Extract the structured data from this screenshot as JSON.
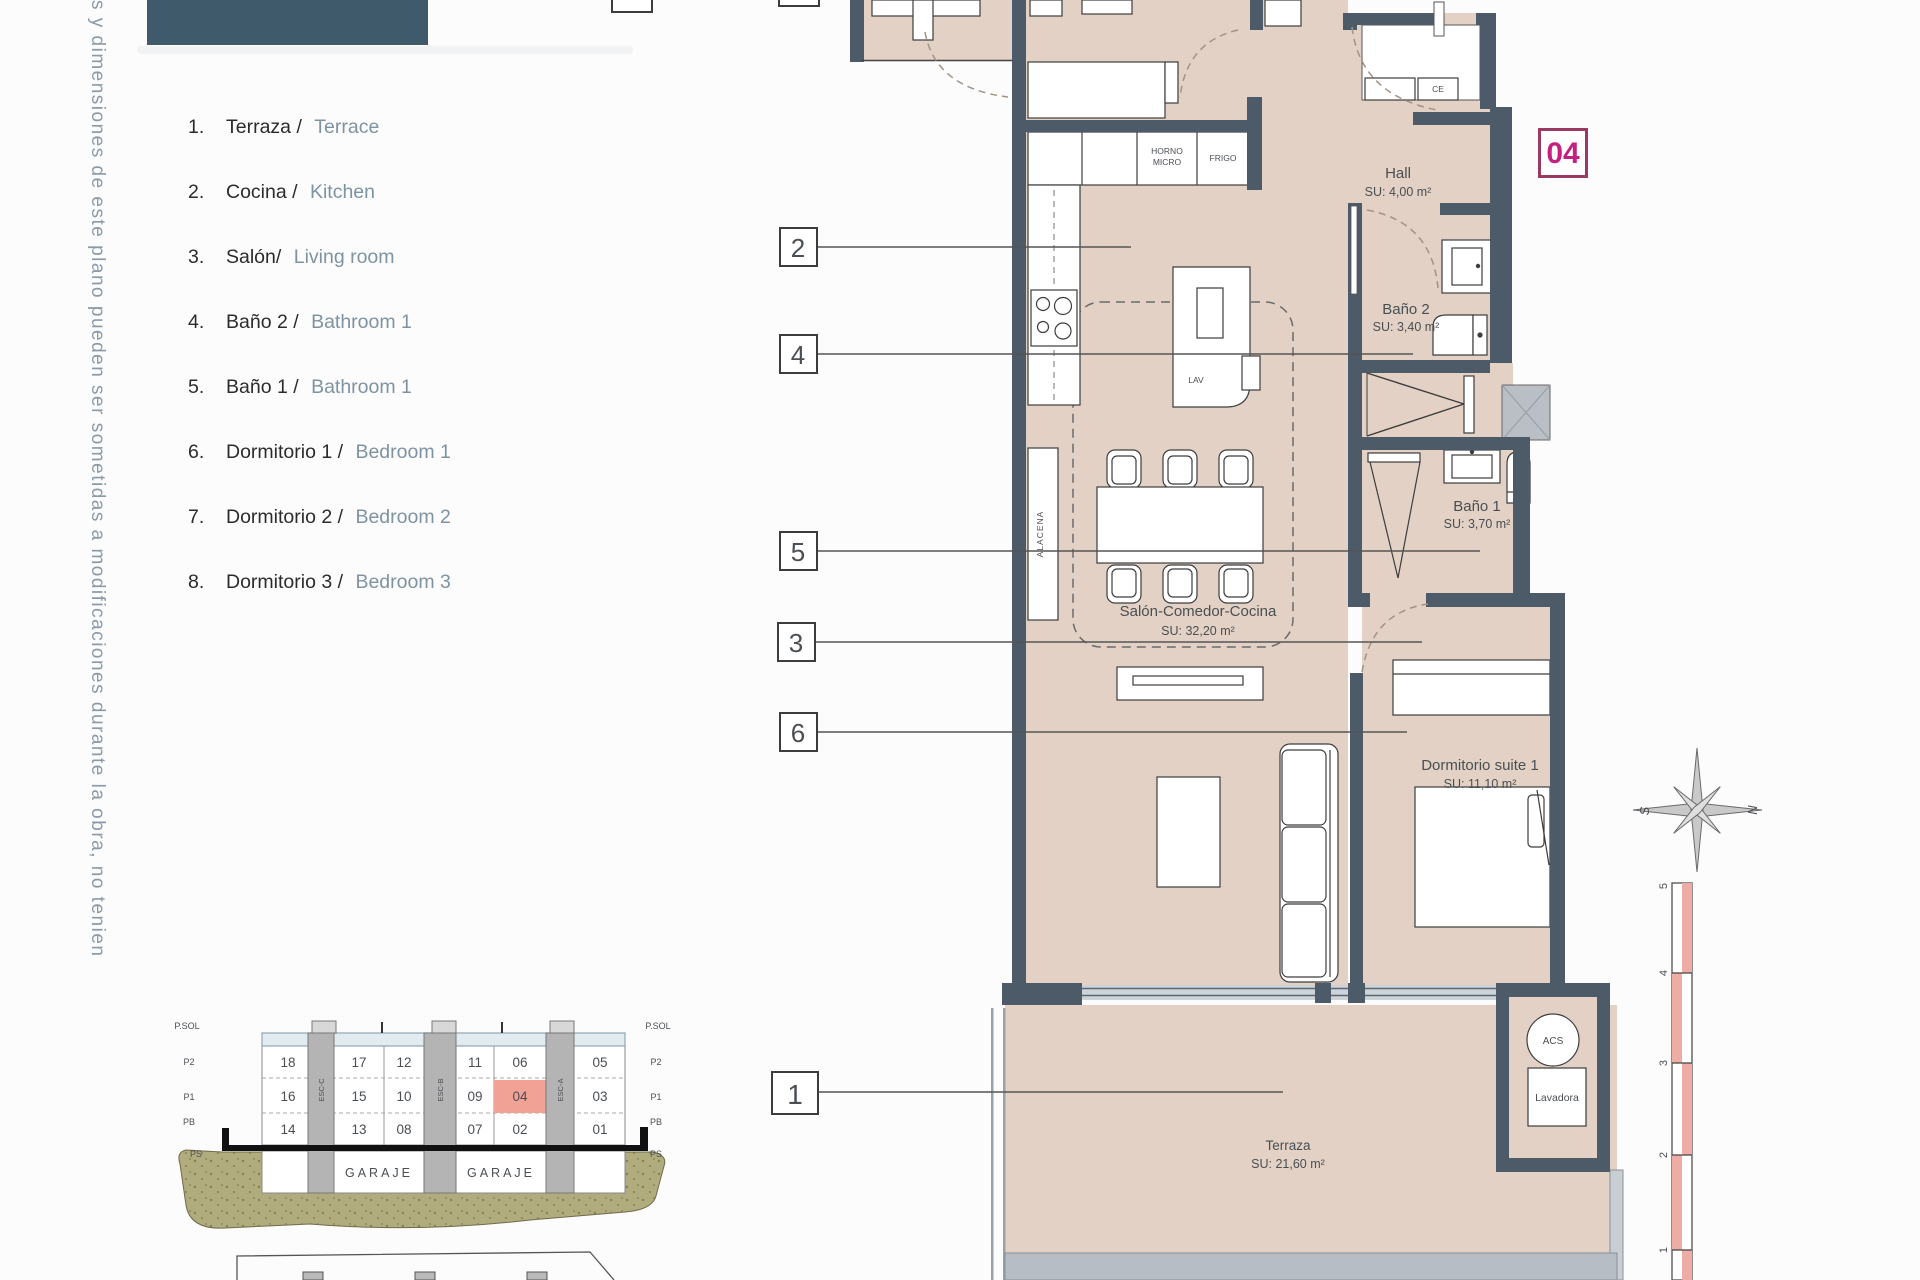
{
  "page": {
    "disclaimer": "s y dimensiones de este plano pueden ser sometidas a modificaciones durante la obra, no tenien",
    "unit_badge": "04"
  },
  "legend": {
    "items": [
      {
        "num": "1.",
        "es": "Terraza / ",
        "en": "Terrace"
      },
      {
        "num": "2.",
        "es": "Cocina / ",
        "en": "Kitchen"
      },
      {
        "num": "3.",
        "es": "Salón/ ",
        "en": "Living room"
      },
      {
        "num": "4.",
        "es": "Baño 2 / ",
        "en": "Bathroom 1"
      },
      {
        "num": "5.",
        "es": "Baño 1 / ",
        "en": "Bathroom 1"
      },
      {
        "num": "6.",
        "es": "Dormitorio 1 / ",
        "en": "Bedroom 1"
      },
      {
        "num": "7.",
        "es": "Dormitorio 2 / ",
        "en": "Bedroom 2"
      },
      {
        "num": "8.",
        "es": "Dormitorio 3 / ",
        "en": "Bedroom 3"
      }
    ]
  },
  "plan": {
    "rooms": {
      "hall": {
        "name": "Hall",
        "area": "SU: 4,00 m²"
      },
      "bano2": {
        "name": "Baño 2",
        "area": "SU: 3,40 m²"
      },
      "bano1": {
        "name": "Baño 1",
        "area": "SU: 3,70 m²"
      },
      "salon": {
        "name": "Salón-Comedor-Cocina",
        "area": "SU: 32,20 m²"
      },
      "suite": {
        "name": "Dormitorio suite 1",
        "area": "SU: 11,10 m²"
      },
      "terraza": {
        "name": "Terraza",
        "area": "SU: 21,60 m²"
      }
    },
    "fixtures": {
      "horno": "HORNO",
      "micro": "MICRO",
      "frigo": "FRIGO",
      "lav": "LAV",
      "alacena": "ALACENA",
      "ce": "CE",
      "acs": "ACS",
      "lavadora": "Lavadora"
    },
    "callouts": {
      "c1": "1",
      "c2": "2",
      "c3": "3",
      "c4": "4",
      "c5": "5",
      "c6": "6"
    },
    "compass": {
      "west": "S",
      "east": "N"
    },
    "scalebar": [
      "5",
      "4",
      "3",
      "2",
      "1"
    ]
  },
  "section": {
    "levels": [
      "P.SOL",
      "P2",
      "P1",
      "PB",
      "PS"
    ],
    "rows": [
      [
        "18",
        "17",
        "12",
        "11",
        "06",
        "05"
      ],
      [
        "16",
        "15",
        "10",
        "09",
        "04",
        "03"
      ],
      [
        "14",
        "13",
        "08",
        "07",
        "02",
        "01"
      ]
    ],
    "stairs": [
      "ESC-C",
      "ESC-B",
      "ESC-A"
    ],
    "garaje": [
      "GARAJE",
      "GARAJE"
    ],
    "highlighted_unit": "04"
  },
  "colors": {
    "accent_magenta": "#c51f7f",
    "badge_border": "#9a3a62",
    "wall": "#4d5b68",
    "floor_beige": "#e2d1c4",
    "highlight_salmon": "#f2a195",
    "header_teal": "#3f5a6b",
    "scale_pink": "#edaca4",
    "ground_olive": "#b0ac7e"
  }
}
